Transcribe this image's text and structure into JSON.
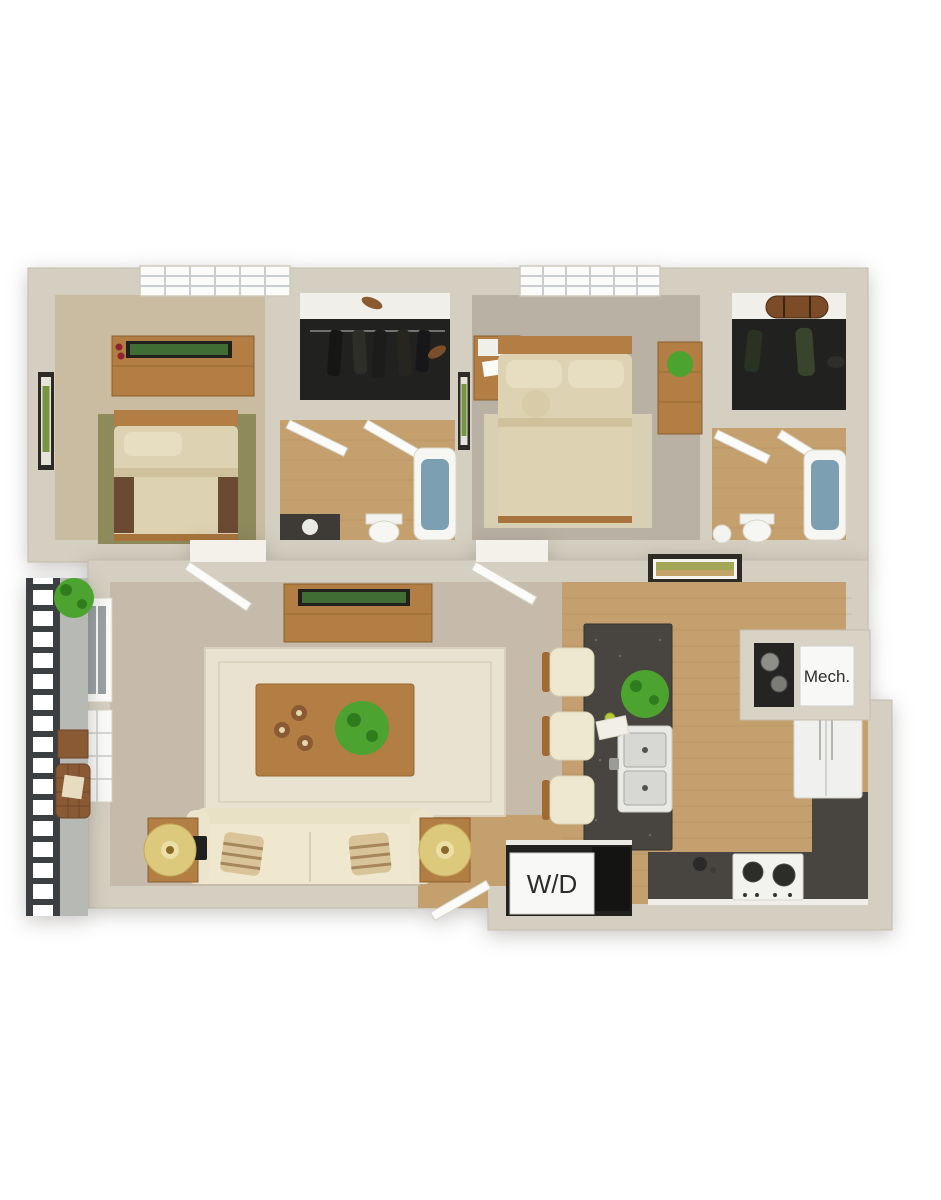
{
  "labels": {
    "mech_closet": "Mech.",
    "washer_dryer": "W/D"
  },
  "colors": {
    "background": "#ffffff",
    "wall": "#d5cfc1",
    "wall_inner_face": "#b5afa1",
    "niche_wall": "#d9d3c5",
    "bedroom1_carpet": "#c9bca0",
    "bedroom2_carpet": "#b9b1a3",
    "living_carpet": "#c6bbaa",
    "wood_floor": "#c5a06f",
    "plank_line": "#a9814f",
    "closet_floor": "#21211f",
    "closet_shelf": "#f0efe9",
    "counter_granite": "#48443f",
    "tub_water": "#7d9fb2",
    "furniture_wood": "#b27e44",
    "furniture_wood_dark": "#8a5f2e",
    "bedding": "#ddd2b2",
    "pillow": "#e7ddc1",
    "bed_accent_brown": "#6b4a32",
    "bedroom1_rug": "#8e8a5c",
    "bedroom2_rug": "#d8cfb5",
    "sofa": "#efe8cf",
    "living_rug": "#e9e2d0",
    "lamp_shade": "#dcc97b",
    "plant_green": "#4da32f",
    "plant_green_dark": "#2f7c1f",
    "railing_metal": "#3c3f41",
    "balcony_floor": "#b7b9b5",
    "door_white": "#fbfbf9",
    "opening_white": "#f3f1ea",
    "appliance_white": "#f0f0ee",
    "appliance_dark": "#141412",
    "label_bg": "#f8f8f6",
    "label_text": "#2c2c2c",
    "frame_dark": "#2e2b26",
    "glass_gray": "#9aa1a3",
    "tv_screen_green": "#3f6d33"
  }
}
